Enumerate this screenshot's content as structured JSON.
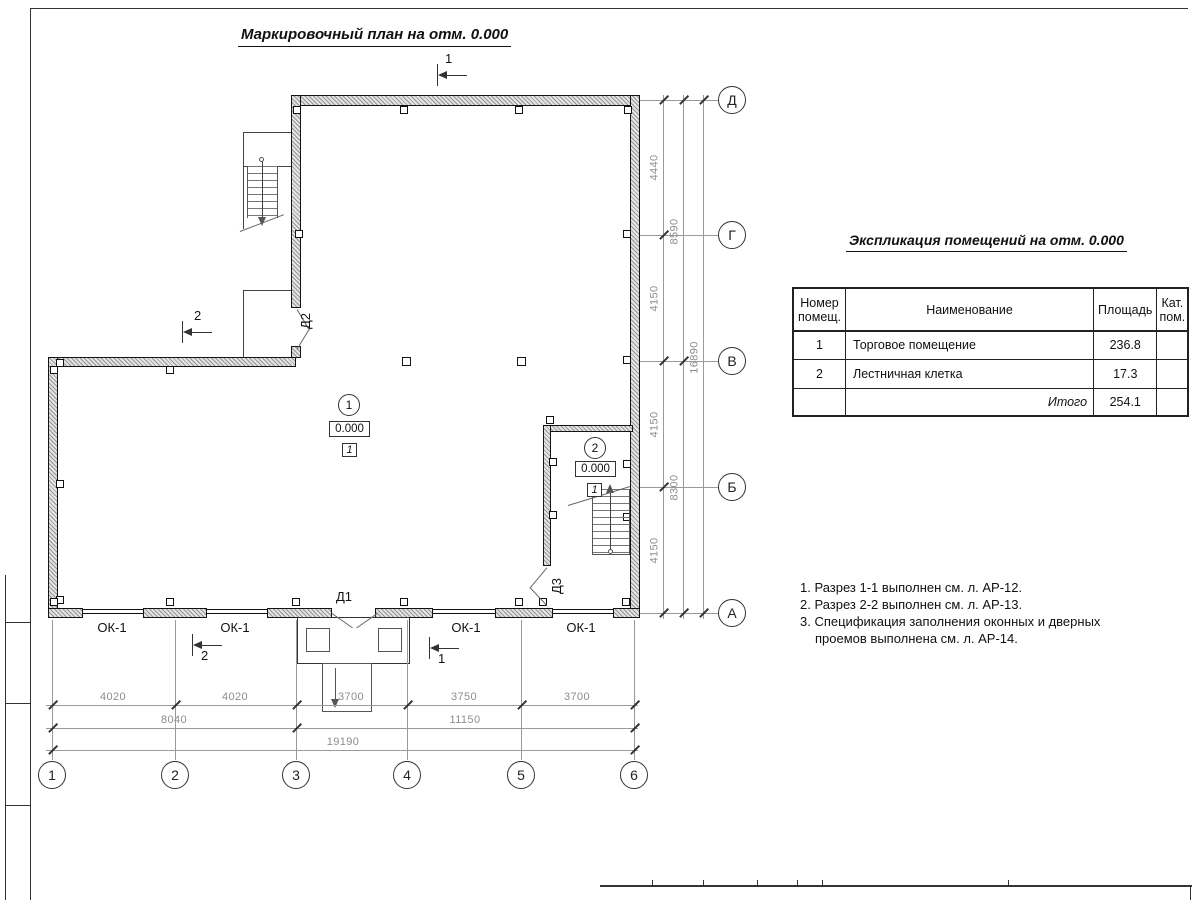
{
  "titles": {
    "plan": "Маркировочный план на отм. 0.000",
    "explication": "Экспликация помещений на отм. 0.000"
  },
  "explication": {
    "headers": {
      "num": "Номер помещ.",
      "name": "Наименование",
      "area": "Площадь",
      "cat": "Кат. пом."
    },
    "rows": [
      {
        "num": "1",
        "name": "Торговое помещение",
        "area": "236.8",
        "cat": ""
      },
      {
        "num": "2",
        "name": "Лестничная клетка",
        "area": "17.3",
        "cat": ""
      }
    ],
    "total": {
      "label": "Итого",
      "area": "254.1"
    }
  },
  "notes": [
    "1. Разрез 1-1 выполнен см. л. АР-12.",
    "2. Разрез 2-2 выполнен см. л. АР-13.",
    "3. Спецификация заполнения оконных и дверных проемов выполнена см. л. АР-14."
  ],
  "axes": {
    "vertical": [
      "Д",
      "Г",
      "В",
      "Б",
      "А"
    ],
    "horizontal": [
      "1",
      "2",
      "3",
      "4",
      "5",
      "6"
    ]
  },
  "dims": {
    "right_tier1": [
      "4440",
      "4150",
      "4150",
      "4150"
    ],
    "right_tier2": [
      "8590",
      "8300"
    ],
    "right_tier3": "16890",
    "bottom_tier1": [
      "4020",
      "4020",
      "3700",
      "3750",
      "3700"
    ],
    "bottom_tier2": [
      "8040",
      "11150"
    ],
    "bottom_tier3": "19190"
  },
  "labels": {
    "window": "ОК-1",
    "door1": "Д1",
    "door2": "Д2",
    "door3": "Д3",
    "section1": "1",
    "section2": "2"
  },
  "rooms": [
    {
      "number": "1",
      "elevation": "0.000",
      "floor": "1"
    },
    {
      "number": "2",
      "elevation": "0.000",
      "floor": "1"
    }
  ]
}
